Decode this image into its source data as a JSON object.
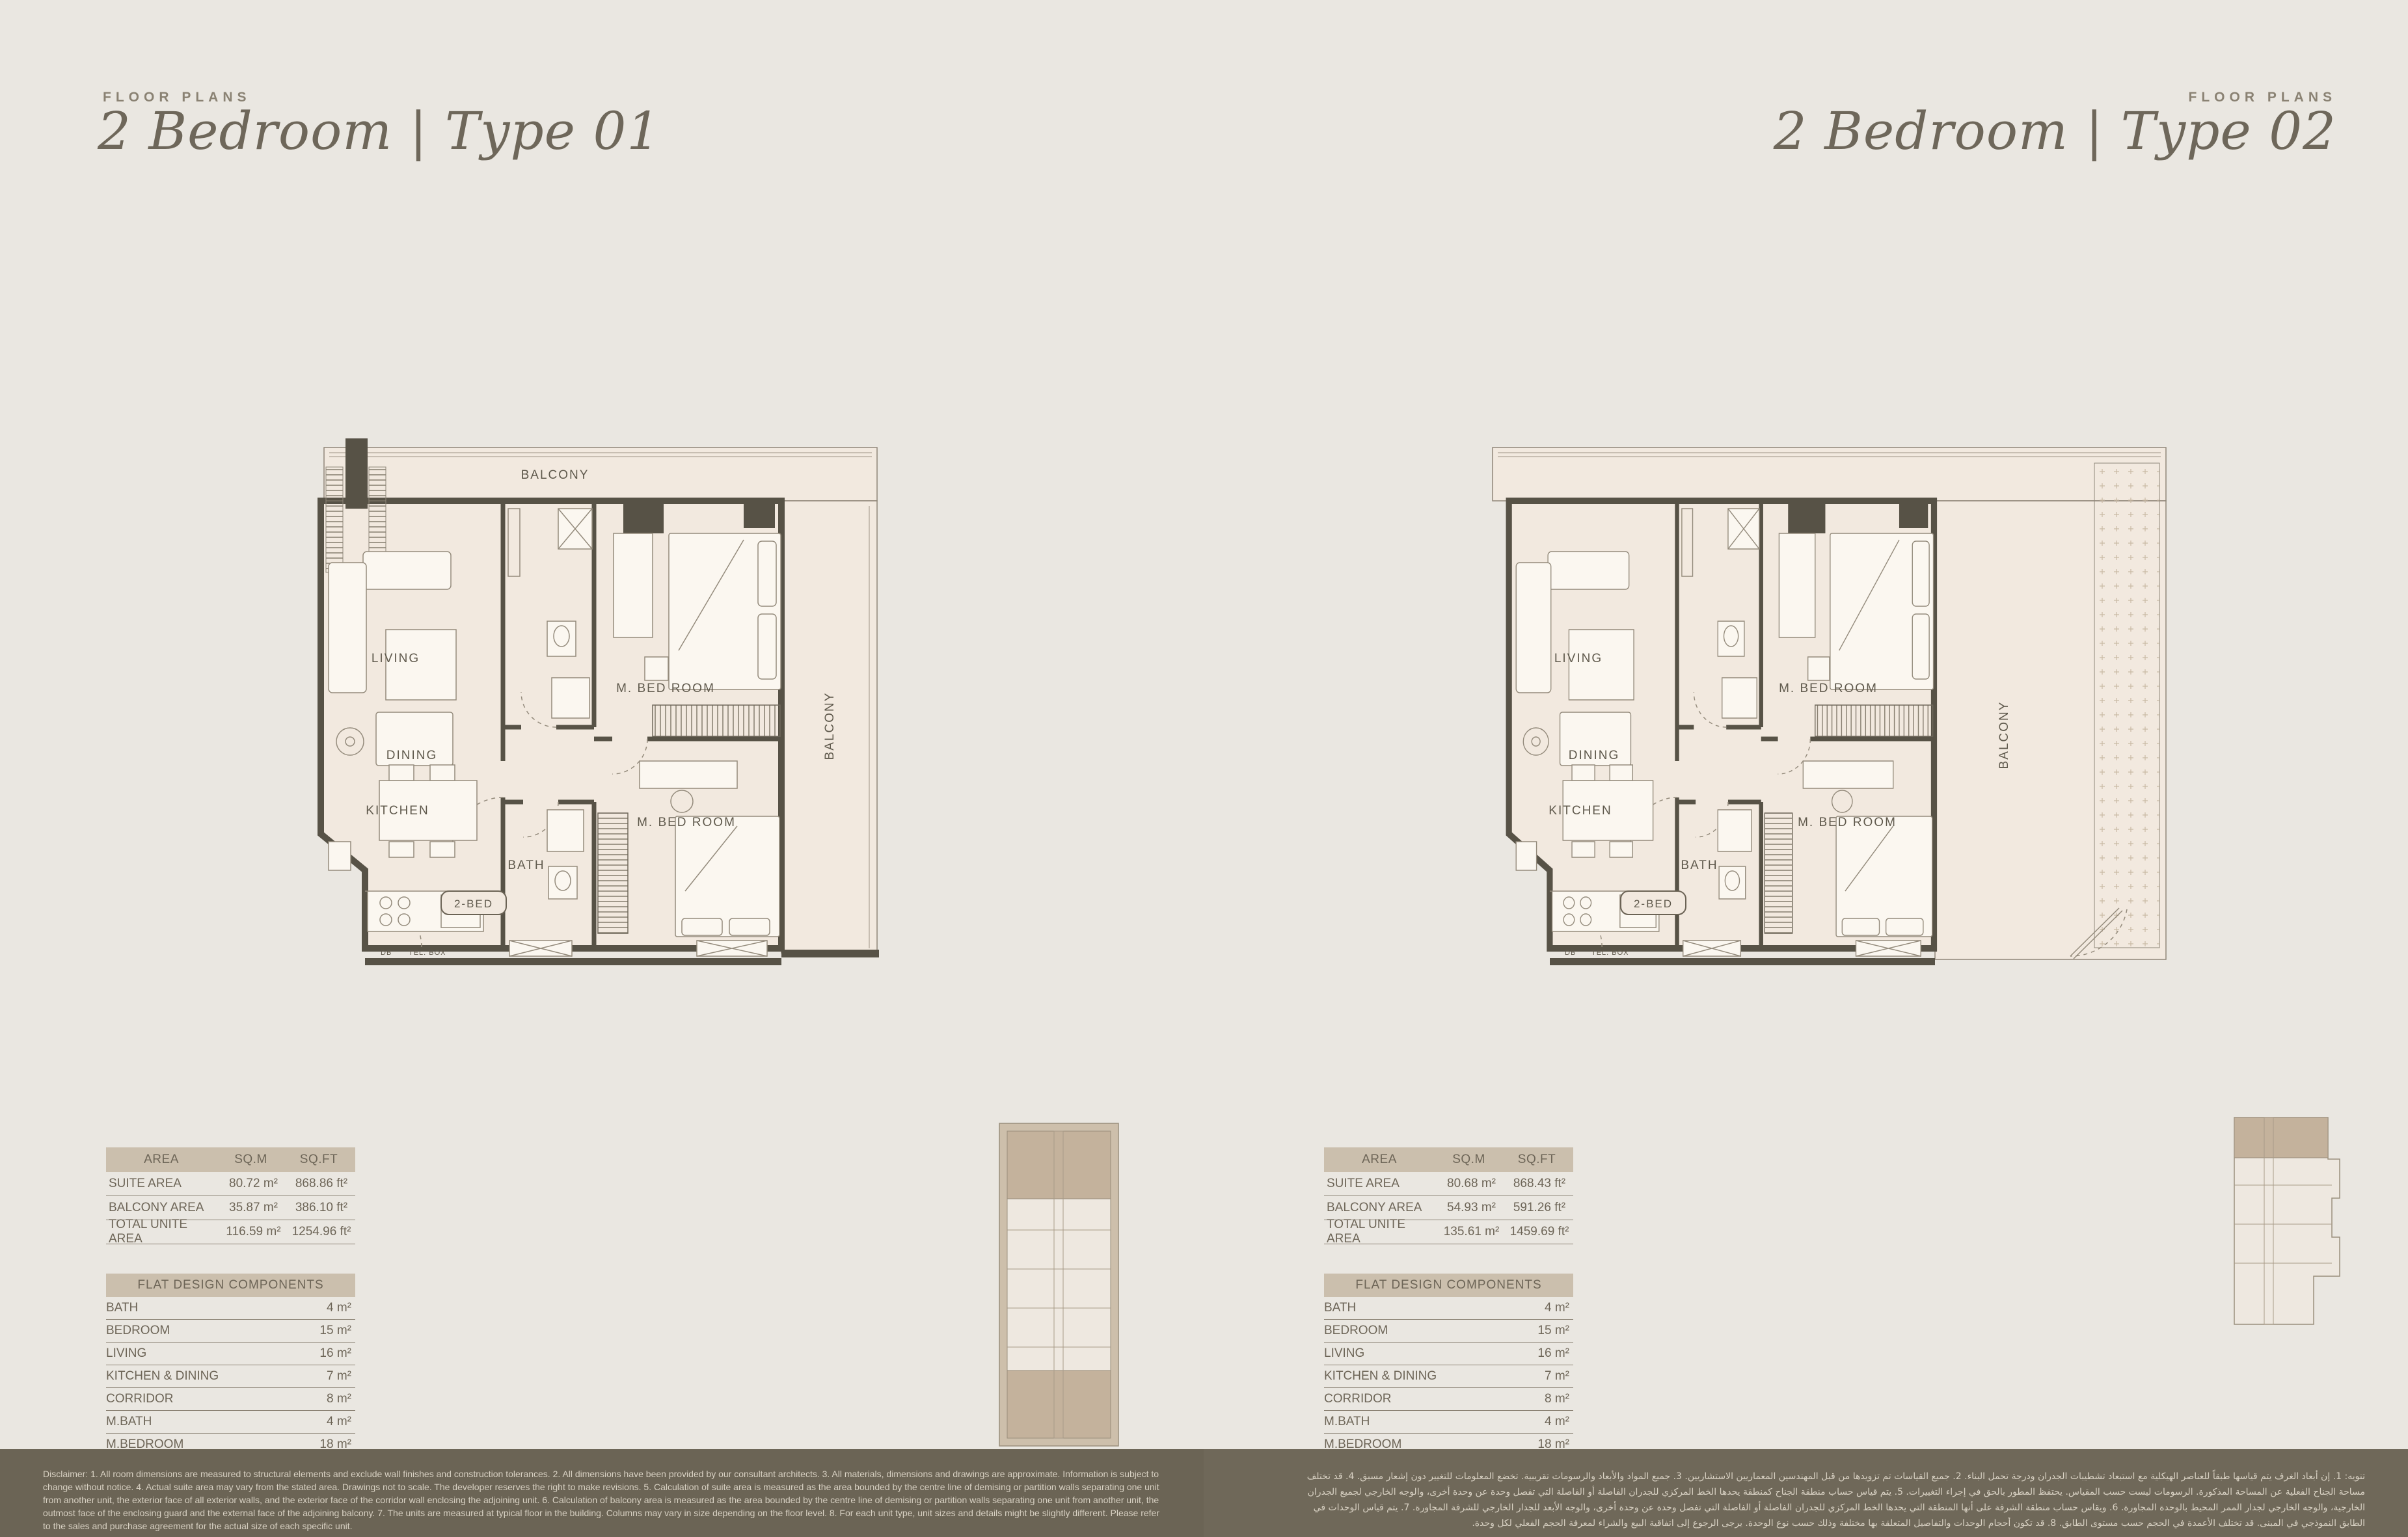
{
  "left": {
    "eyebrow": "FLOOR PLANS",
    "title": "2 Bedroom | Type 01",
    "plan": {
      "balcony_top": "BALCONY",
      "balcony_side": "BALCONY",
      "living": "LIVING",
      "dining": "DINING",
      "kitchen": "KITCHEN",
      "bath": "BATH",
      "master_bedroom_1": "M. BED ROOM",
      "master_bedroom_2": "M. BED ROOM",
      "unit_tag": "2-BED",
      "db": "DB",
      "tel_box": "TEL. BOX"
    },
    "area_table": {
      "headers": [
        "AREA",
        "SQ.M",
        "SQ.FT"
      ],
      "rows": [
        {
          "label": "SUITE AREA",
          "sqm": "80.72 m²",
          "sqft": "868.86 ft²"
        },
        {
          "label": "BALCONY AREA",
          "sqm": "35.87 m²",
          "sqft": "386.10 ft²"
        },
        {
          "label": "TOTAL UNITE AREA",
          "sqm": "116.59 m²",
          "sqft": "1254.96 ft²"
        }
      ]
    },
    "components_table": {
      "title": "FLAT DESIGN COMPONENTS",
      "rows": [
        {
          "label": "BATH",
          "value": "4 m²"
        },
        {
          "label": "BEDROOM",
          "value": "15 m²"
        },
        {
          "label": "LIVING",
          "value": "16 m²"
        },
        {
          "label": "KITCHEN & DINING",
          "value": "7 m²"
        },
        {
          "label": "CORRIDOR",
          "value": "8 m²"
        },
        {
          "label": "M.BATH",
          "value": "4 m²"
        },
        {
          "label": "M.BEDROOM",
          "value": "18 m²"
        }
      ]
    }
  },
  "right": {
    "eyebrow": "FLOOR PLANS",
    "title": "2 Bedroom | Type 02",
    "plan": {
      "balcony_side": "BALCONY",
      "living": "LIVING",
      "dining": "DINING",
      "kitchen": "KITCHEN",
      "bath": "BATH",
      "master_bedroom_1": "M. BED ROOM",
      "master_bedroom_2": "M. BED ROOM",
      "unit_tag": "2-BED",
      "db": "DB",
      "tel_box": "TEL. BOX"
    },
    "area_table": {
      "headers": [
        "AREA",
        "SQ.M",
        "SQ.FT"
      ],
      "rows": [
        {
          "label": "SUITE AREA",
          "sqm": "80.68 m²",
          "sqft": "868.43 ft²"
        },
        {
          "label": "BALCONY AREA",
          "sqm": "54.93 m²",
          "sqft": "591.26 ft²"
        },
        {
          "label": "TOTAL UNITE AREA",
          "sqm": "135.61 m²",
          "sqft": "1459.69 ft²"
        }
      ]
    },
    "components_table": {
      "title": "FLAT DESIGN COMPONENTS",
      "rows": [
        {
          "label": "BATH",
          "value": "4 m²"
        },
        {
          "label": "BEDROOM",
          "value": "15 m²"
        },
        {
          "label": "LIVING",
          "value": "16 m²"
        },
        {
          "label": "KITCHEN & DINING",
          "value": "7 m²"
        },
        {
          "label": "CORRIDOR",
          "value": "8 m²"
        },
        {
          "label": "M.BATH",
          "value": "4 m²"
        },
        {
          "label": "M.BEDROOM",
          "value": "18 m²"
        }
      ]
    }
  },
  "footer": {
    "disclaimer_en": "Disclaimer: 1. All room dimensions are measured to structural elements and exclude wall finishes and construction tolerances. 2. All dimensions have been provided by our consultant architects. 3. All materials, dimensions and drawings are approximate. Information is subject to change without notice. 4. Actual suite area may vary from the stated area. Drawings not to scale. The developer reserves the right to make revisions. 5. Calculation of suite area is measured as the area bounded by the centre line of demising or partition walls separating one unit from another unit, the exterior face of all exterior walls, and the exterior face of the corridor wall enclosing the adjoining unit. 6. Calculation of balcony area is measured as the area bounded by the centre line of demising or partition walls separating one unit from another unit, the outmost face of the enclosing guard and the external face of the adjoining balcony. 7. The units are measured at typical floor in the building. Columns may vary in size depending on the floor level. 8. For each unit type, unit sizes and details might be slightly different. Please refer to the sales and purchase agreement for the actual size of each specific unit.",
    "disclaimer_ar": "تنويه: 1. إن أبعاد الغرف يتم قياسها طبقاً للعناصر الهيكلية مع استبعاد تشطيبات الجدران ودرجة تحمل البناء. 2. جميع القياسات تم تزويدها من قبل المهندسين المعماريين الاستشاريين. 3. جميع المواد والأبعاد والرسومات تقريبية. تخضع المعلومات للتغيير دون إشعار مسبق. 4. قد تختلف مساحة الجناح الفعلية عن المساحة المذكورة. الرسومات ليست حسب المقياس. يحتفظ المطور بالحق في إجراء التغييرات. 5. يتم قياس حساب منطقة الجناح كمنطقة يحدها الخط المركزي للجدران الفاصلة أو الفاصلة التي تفصل وحدة عن وحدة أخرى، والوجه الخارجي لجميع الجدران الخارجية، والوجه الخارجي لجدار الممر المحيط بالوحدة المجاورة. 6. ويقاس حساب منطقة الشرفة على أنها المنطقة التي يحدها الخط المركزي للجدران الفاصلة أو الفاصلة التي تفصل وحدة عن وحدة أخرى، والوجه الأبعد للجدار الخارجي للشرفة المجاورة. 7. يتم قياس الوحدات في الطابق النموذجي في المبنى. قد تختلف الأعمدة في الحجم حسب مستوى الطابق. 8. قد تكون أحجام الوحدات والتفاصيل المتعلقة بها مختلفة وذلك حسب نوع الوحدة. يرجى الرجوع إلى اتفاقية البيع والشراء لمعرفة الحجم الفعلي لكل وحدة."
  },
  "colors": {
    "background": "#eae7e1",
    "plan_fill": "#f2e9df",
    "wall": "#575246",
    "table_header": "#cbbfad",
    "footer_left": "#6b6455",
    "footer_right": "#6f6859",
    "text": "#6d6557",
    "keyplan_highlight": "#c4b29c"
  }
}
